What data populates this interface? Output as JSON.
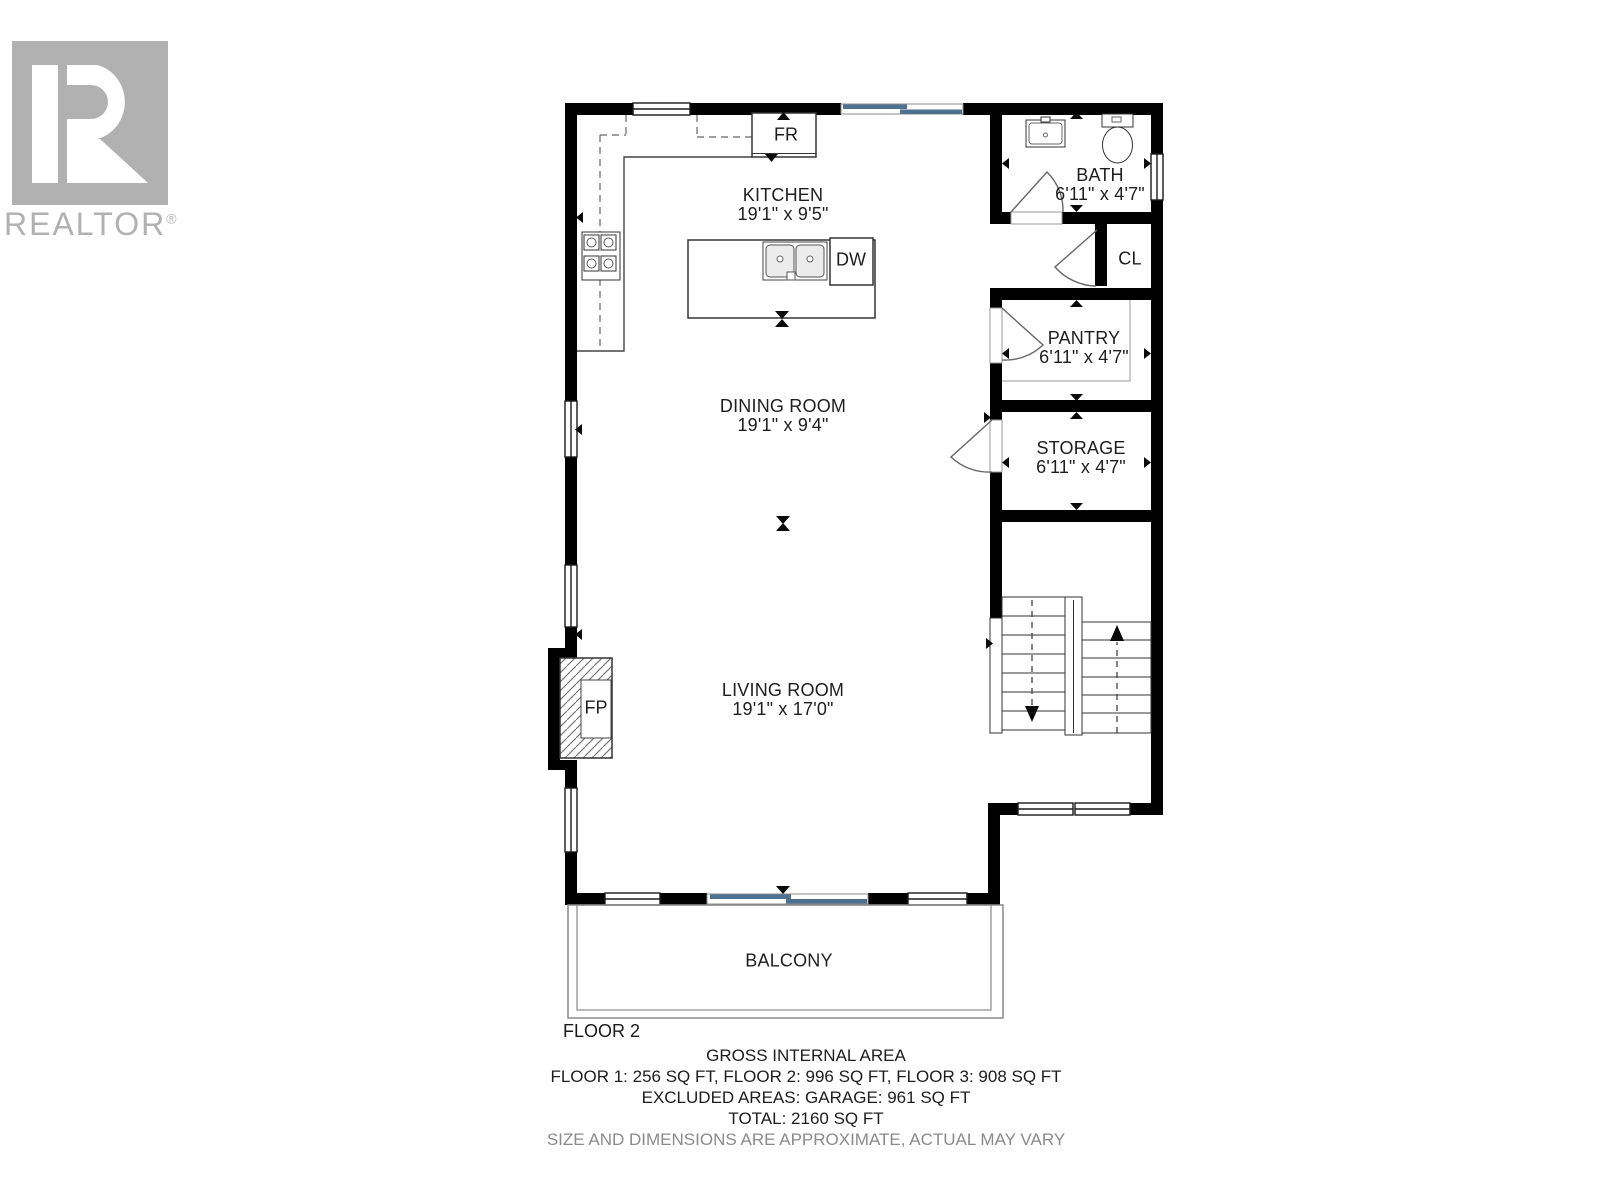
{
  "logo": {
    "brand": "REALTOR",
    "registered": "®"
  },
  "plan": {
    "floor_label": "FLOOR 2",
    "rooms": [
      {
        "id": "kitchen",
        "name": "KITCHEN",
        "dims": "19'1\" x 9'5\""
      },
      {
        "id": "dining-room",
        "name": "DINING ROOM",
        "dims": "19'1\" x 9'4\""
      },
      {
        "id": "living-room",
        "name": "LIVING ROOM",
        "dims": "19'1\" x 17'0\""
      },
      {
        "id": "bath",
        "name": "BATH",
        "dims": "6'11\" x 4'7\""
      },
      {
        "id": "pantry",
        "name": "PANTRY",
        "dims": "6'11\" x 4'7\""
      },
      {
        "id": "storage",
        "name": "STORAGE",
        "dims": "6'11\" x 4'7\""
      },
      {
        "id": "balcony",
        "name": "BALCONY",
        "dims": ""
      },
      {
        "id": "closet",
        "name": "CL",
        "dims": ""
      }
    ],
    "fixtures": [
      {
        "id": "refrigerator",
        "label": "FR"
      },
      {
        "id": "dishwasher",
        "label": "DW"
      },
      {
        "id": "fireplace",
        "label": "FP"
      }
    ]
  },
  "footer": {
    "title": "GROSS INTERNAL AREA",
    "line_floors": "FLOOR 1: 256 SQ FT, FLOOR 2: 996 SQ FT, FLOOR 3: 908 SQ FT",
    "line_excluded": "EXCLUDED AREAS: GARAGE: 961 SQ FT",
    "line_total": "TOTAL: 2160 SQ FT",
    "disclaimer": "SIZE AND DIMENSIONS ARE APPROXIMATE, ACTUAL MAY VARY"
  },
  "colors": {
    "wall": "#000000",
    "glass_door": "#4d7191",
    "logo_gray": "#b1b1b1",
    "disclaimer_gray": "#8a8a8a"
  }
}
